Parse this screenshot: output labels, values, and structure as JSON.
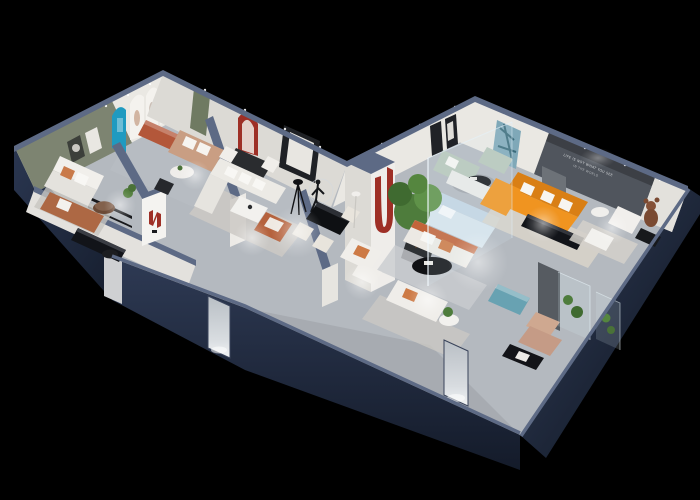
{
  "scene": {
    "description": "Isometric 3D cutaway rendering of a furniture showroom floor plan on a black background, two wings of rooms with navy exterior walls, light grey floors and spot-lit furniture displays",
    "wall_slogan": {
      "line1": "LIFE IS NOT WHAT YOU SEE",
      "line2": "IN THE WORLD"
    }
  },
  "colors": {
    "background": "#000000",
    "wall_top": "#5d6a85",
    "floor": "#b4b9bf",
    "interior_wall": "#eae8e3",
    "green_wall": "#7d8471",
    "blue_arch": "#1f9ac0",
    "red_accent": "#9e2f26",
    "green_door": "#6f7a62",
    "orange_sofa": "#f09420",
    "orange_sofa_deep": "#d97f15",
    "terracotta": "#b3573a",
    "leather": "#ad6844",
    "sage": "#b7c6ba",
    "teal": "#68a2b2",
    "tree_green": "#4e7c3c",
    "dark_panel": "#50555d",
    "white_fabric": "#eceae6",
    "black_furniture": "#121419"
  }
}
